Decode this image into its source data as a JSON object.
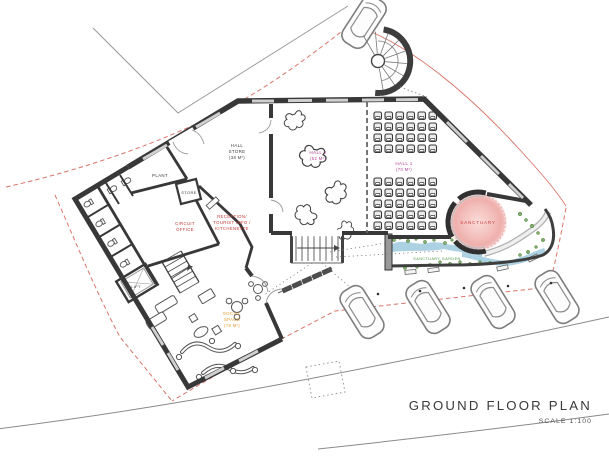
{
  "title": {
    "label": "GROUND FLOOR PLAN",
    "scale": "SCALE 1:100"
  },
  "rooms": {
    "hall_store": {
      "line1": "HALL",
      "line2": "STORE",
      "area": "(38 M²)"
    },
    "hall2": {
      "name": "HALL 2",
      "area": "(52 M²)"
    },
    "hall1": {
      "name": "HALL 1",
      "area": "(70 M²)"
    },
    "sanctuary": {
      "name": "SANCTUARY"
    },
    "sanctuary_garden": {
      "name": "SANCTUARY GARDEN"
    },
    "reception": {
      "line1": "RECEPTION/",
      "line2": "TOURIST INFO /",
      "line3": "KITCHENETTE"
    },
    "circuit_office": {
      "line1": "CIRCUIT",
      "line2": "OFFICE"
    },
    "plant": {
      "name": "PLANT"
    },
    "store": {
      "name": "STORE"
    },
    "lift": {
      "name": "LIFT"
    },
    "social": {
      "line1": "SOCIAL",
      "line2": "SPACE",
      "area": "(78 M²)"
    }
  },
  "colors": {
    "boundary_red": "#d9756b",
    "wall_dark": "#383838",
    "window_gray": "#cfcfcf",
    "label_red": "#c43b33",
    "label_magenta": "#b53e92",
    "label_orange": "#e29b2e",
    "label_green": "#46953f",
    "label_black": "#3d3d3d",
    "water_blue": "#9ec9de",
    "shrub_green": "#7fb069",
    "sanctuary_pink": "#f3bcbc",
    "title_color": "#3a3a3a"
  }
}
